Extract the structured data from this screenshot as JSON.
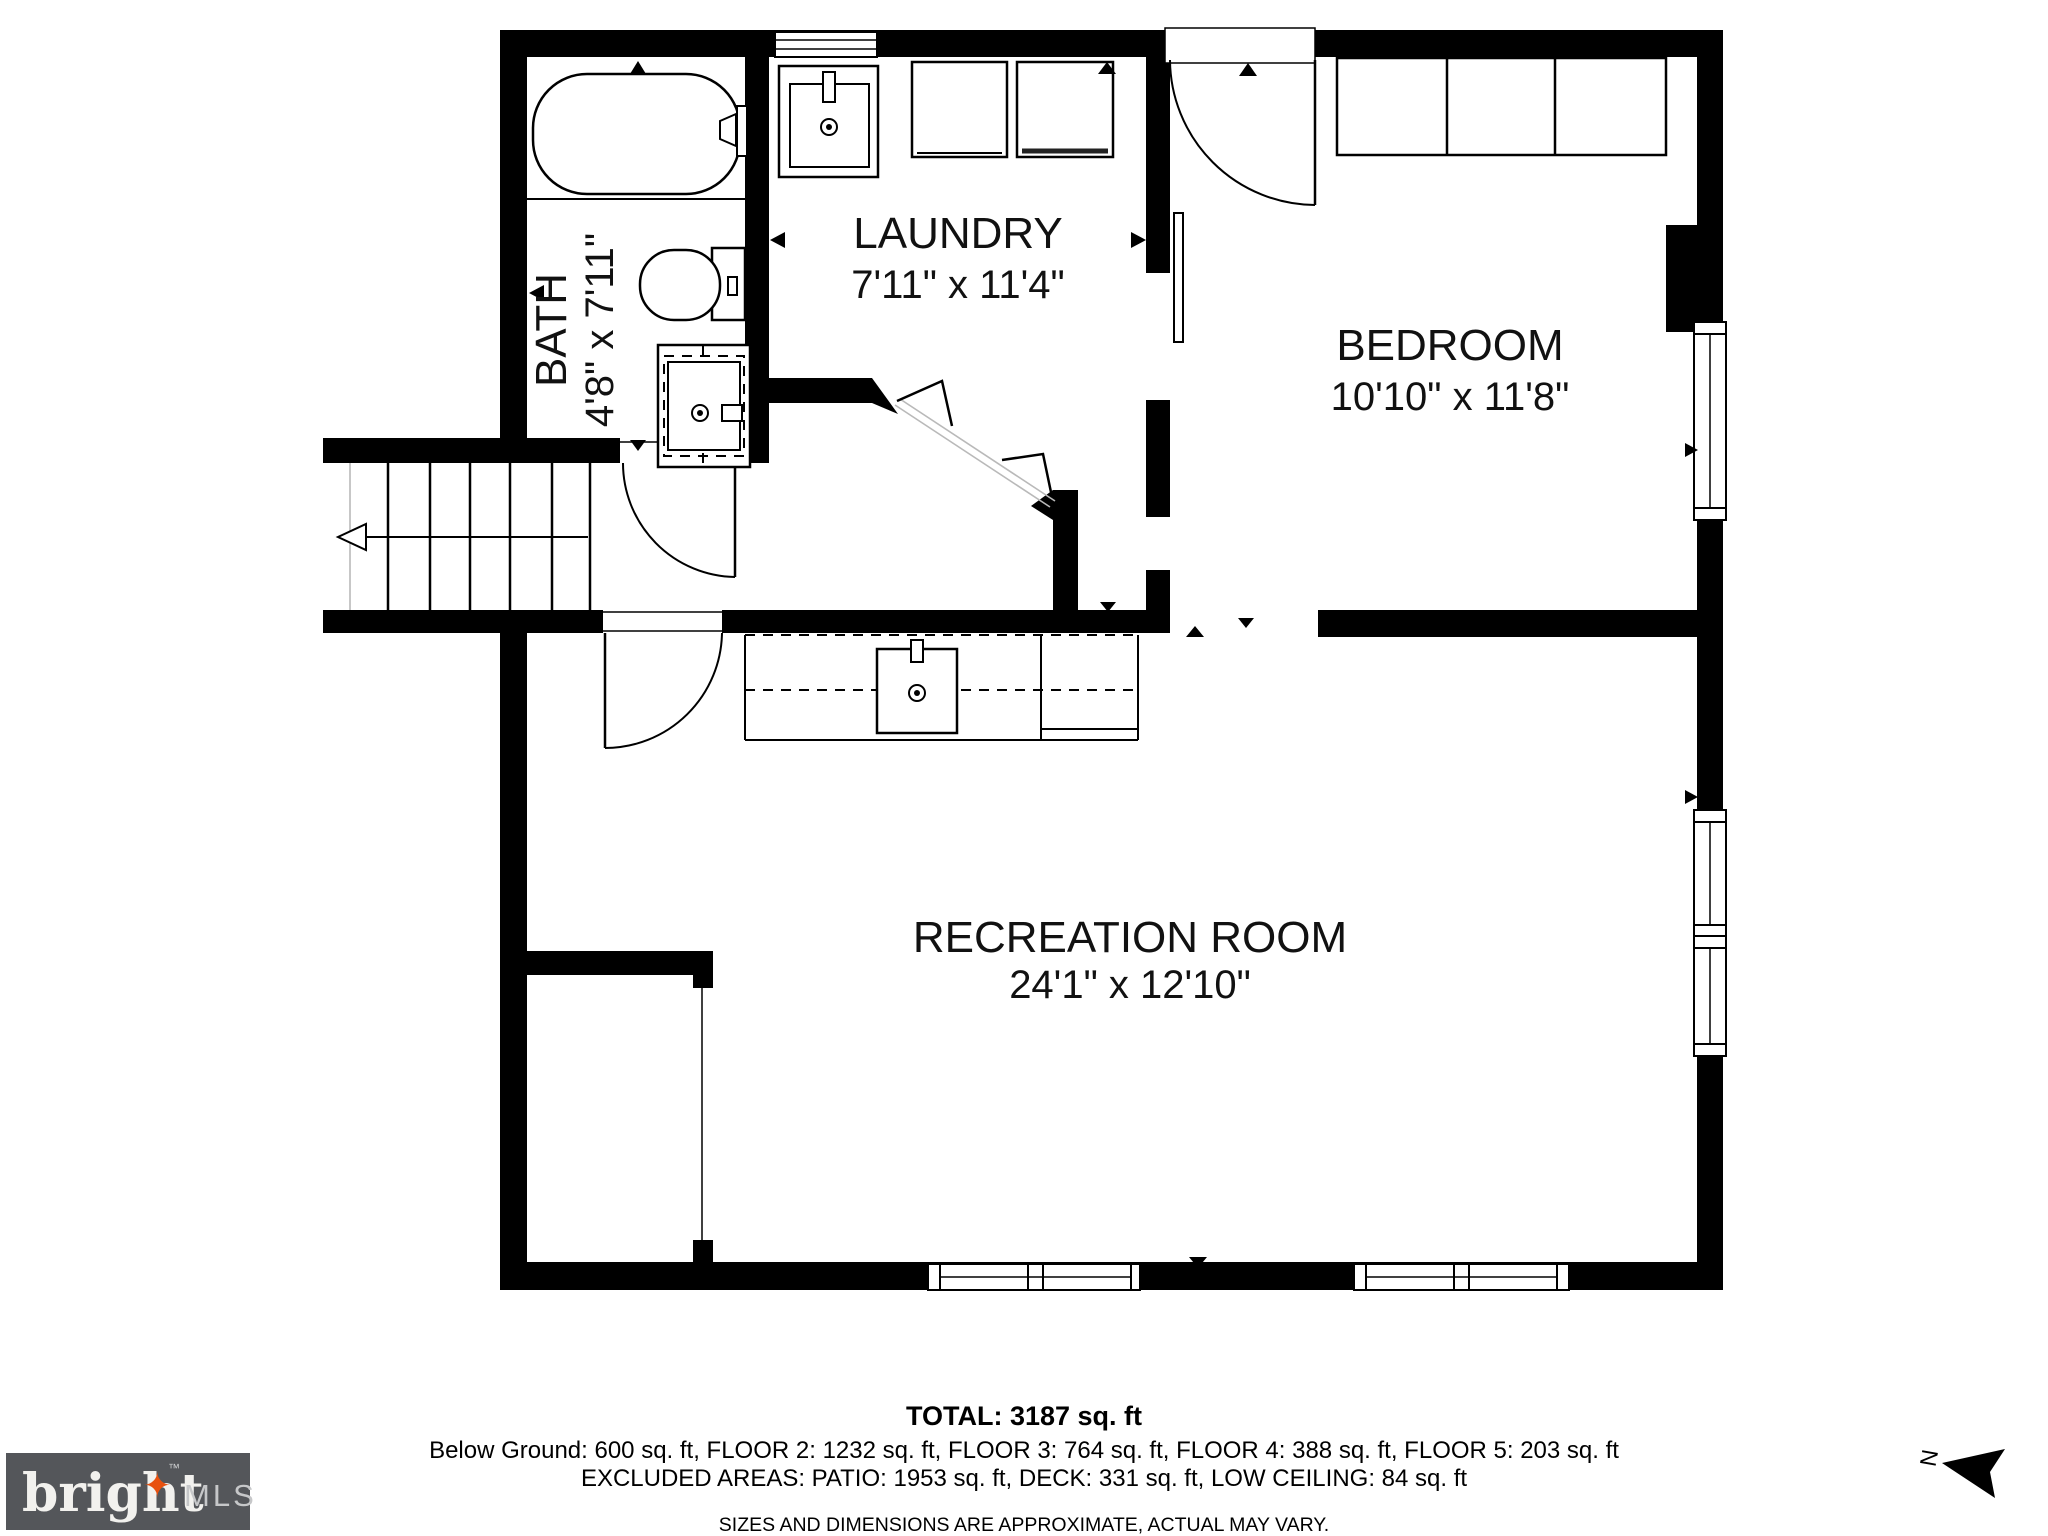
{
  "plan": {
    "rooms": {
      "bath": {
        "label": "BATH",
        "dims": "4'8\" x 7'11\""
      },
      "laundry": {
        "label": "LAUNDRY",
        "dims": "7'11\" x 11'4\""
      },
      "bedroom": {
        "label": "BEDROOM",
        "dims": "10'10\" x 11'8\""
      },
      "recreation": {
        "label": "RECREATION ROOM",
        "dims": "24'1\" x 12'10\""
      }
    },
    "compass": {
      "north_label": "N"
    }
  },
  "footer": {
    "total": "TOTAL: 3187 sq. ft",
    "floors": "Below Ground: 600 sq. ft, FLOOR 2: 1232 sq. ft, FLOOR 3: 764 sq. ft, FLOOR 4: 388 sq. ft, FLOOR 5: 203 sq. ft",
    "excluded": "EXCLUDED AREAS: PATIO: 1953 sq. ft, DECK: 331 sq. ft, LOW CEILING: 84 sq. ft",
    "disclaimer": "SIZES AND DIMENSIONS ARE APPROXIMATE, ACTUAL MAY VARY."
  },
  "logo": {
    "brand": "bright",
    "tm": "™",
    "suffix": "MLS",
    "star": "✦",
    "bg_color": "#54565A",
    "star_color": "#E8500E"
  }
}
